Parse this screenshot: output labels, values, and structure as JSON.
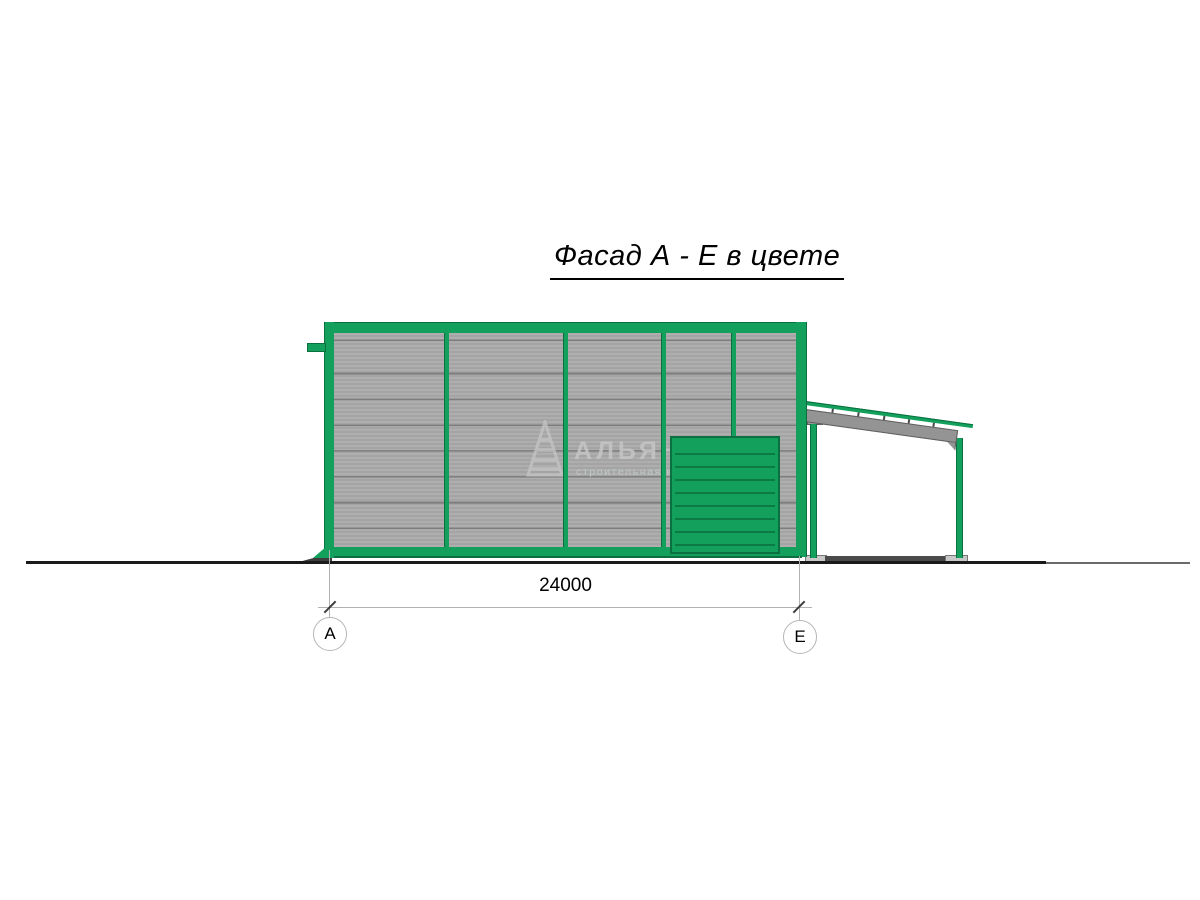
{
  "title": "Фасад А - Е в цвете",
  "dimension": {
    "label": "24000"
  },
  "axis_markers": {
    "left": "А",
    "right": "Е"
  },
  "watermark": {
    "brand": "АЛЬЯНС",
    "tagline": "строительная компания",
    "logo_icon": "striped-pyramid-icon"
  },
  "colors": {
    "frame-green": "#12A05C",
    "frame-green-dark": "#0B6F3F",
    "door-slat-dark": "#0C7A45",
    "panel-gray": "#A9A9A9",
    "panel-seam": "#7D7D7D",
    "beam-gray": "#949494",
    "beam-outline": "#5F5F5F",
    "ground-black": "#1A1A1A",
    "ground-gray": "#6B6B6B",
    "plate-gray": "#C8C8C8",
    "dark-strip": "#4A4A4A",
    "dim-line-gray": "#B2B2B2",
    "watermark-gray": "#C6C6C6",
    "watermark-tagline": "#C2CDC5"
  }
}
